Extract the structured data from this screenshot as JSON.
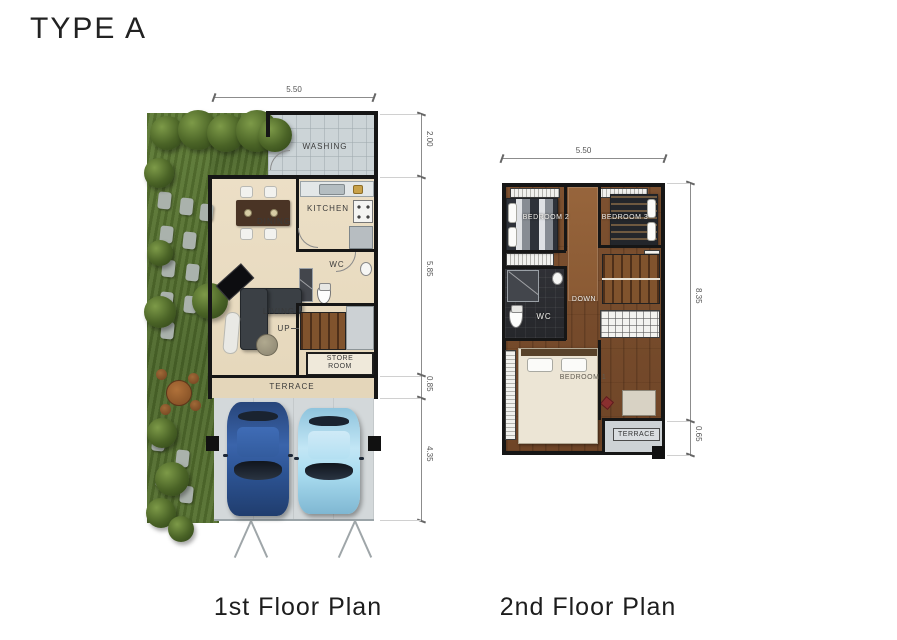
{
  "title": "TYPE A",
  "captions": {
    "first": "1st Floor Plan",
    "second": "2nd Floor Plan"
  },
  "first_floor": {
    "dim_width": "5.50",
    "dims_right": [
      "2.00",
      "5.85",
      "0.85",
      "4.35"
    ],
    "labels": {
      "washing": "WASHING",
      "dining": "DINING",
      "kitchen": "KITCHEN",
      "wc": "WC",
      "living": "LIVING",
      "up": "UP",
      "store_room": "STORE ROOM",
      "terrace": "TERRACE"
    }
  },
  "second_floor": {
    "dim_width": "5.50",
    "dims_right": [
      "8.35",
      "0.65"
    ],
    "labels": {
      "bedroom2": "BEDROOM 2",
      "bedroom3": "BEDROOM 3",
      "down": "DOWN",
      "wc": "WC",
      "bedroom1": "BEDROOM 1",
      "terrace": "TERRACE"
    }
  },
  "colors": {
    "wall": "#161616",
    "garden_green": "#55712f",
    "floor_beige": "#e9dcc2",
    "wood_brown": "#7a4e2c",
    "tile_gray": "#ccd4d7",
    "car_dark_blue": "#30548f",
    "car_light_blue": "#a9d8ec",
    "wc_dark": "#2b2c30"
  }
}
